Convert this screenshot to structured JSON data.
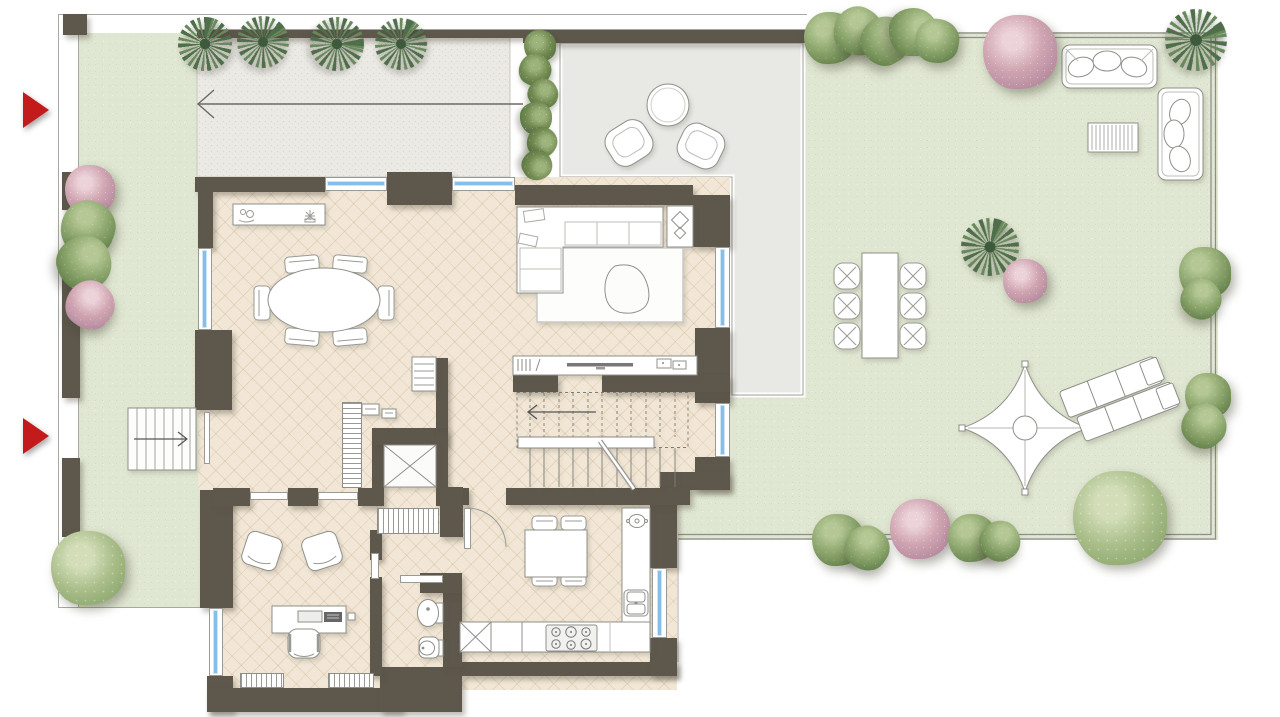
{
  "meta": {
    "kind": "architectural floor plan, top-down render",
    "scene": "ground floor apartment with wrap-around garden, gravel driveway and paved terrace",
    "visible_text": "none"
  },
  "colors": {
    "wall": "#5d574c",
    "floor": "#f2e7d6",
    "floor_line": "rgba(200,175,140,.32)",
    "green": "#dfe6d1",
    "green_dot": "#d0dbc0",
    "gravel": "#eceae5",
    "terrace": "#e8e8e5",
    "outline": "#8f8f8a",
    "thin_line": "#a8a8a3",
    "glass": "#85bfe9",
    "glass_light": "#cfe6f7",
    "red": "#c31b1c"
  },
  "entrance_markers": [
    {
      "n": "entrance-marker-top",
      "x": 23,
      "y": 92
    },
    {
      "n": "entrance-marker-bottom",
      "x": 23,
      "y": 418
    }
  ],
  "windows": [
    {
      "n": "window-dining-top-1",
      "o": "h",
      "x": 325,
      "y": 177,
      "w": 62,
      "h": 14
    },
    {
      "n": "window-dining-top-2",
      "o": "h",
      "x": 452,
      "y": 177,
      "w": 63,
      "h": 14
    },
    {
      "n": "window-dining-left",
      "o": "v",
      "x": 198,
      "y": 248,
      "w": 14,
      "h": 82
    },
    {
      "n": "window-living-right",
      "o": "v",
      "x": 715,
      "y": 247,
      "w": 15,
      "h": 81
    },
    {
      "n": "window-stairhall-right",
      "o": "v",
      "x": 715,
      "y": 403,
      "w": 15,
      "h": 54
    },
    {
      "n": "window-kitchen-right",
      "o": "v",
      "x": 652,
      "y": 568,
      "w": 15,
      "h": 70
    },
    {
      "n": "window-office-left",
      "o": "v",
      "x": 209,
      "y": 608,
      "w": 14,
      "h": 68
    }
  ],
  "walls": [
    {
      "n": "pillar-top-left",
      "x": 63,
      "y": 14,
      "w": 24,
      "h": 21
    },
    {
      "n": "boundary-seg-1",
      "x": 62,
      "y": 172,
      "w": 18,
      "h": 38
    },
    {
      "n": "boundary-seg-2",
      "x": 62,
      "y": 265,
      "w": 18,
      "h": 133
    },
    {
      "n": "boundary-seg-3",
      "x": 62,
      "y": 458,
      "w": 18,
      "h": 79
    },
    {
      "n": "gravel-top-wall",
      "x": 197,
      "y": 30,
      "w": 326,
      "h": 8
    },
    {
      "n": "terrace-top-wall",
      "x": 523,
      "y": 30,
      "w": 284,
      "h": 13
    },
    {
      "n": "top-wall-left",
      "x": 195,
      "y": 177,
      "w": 130,
      "h": 15
    },
    {
      "n": "top-wall-pier",
      "x": 387,
      "y": 172,
      "w": 65,
      "h": 33
    },
    {
      "n": "top-wall-living",
      "x": 515,
      "y": 185,
      "w": 178,
      "h": 20
    },
    {
      "n": "right-wall-a",
      "x": 693,
      "y": 195,
      "w": 37,
      "h": 52
    },
    {
      "n": "right-wall-b",
      "x": 695,
      "y": 328,
      "w": 35,
      "h": 75
    },
    {
      "n": "right-wall-c",
      "x": 695,
      "y": 457,
      "w": 35,
      "h": 33
    },
    {
      "n": "right-wall-connector",
      "x": 660,
      "y": 472,
      "w": 70,
      "h": 18
    },
    {
      "n": "left-wall-a",
      "x": 198,
      "y": 192,
      "w": 15,
      "h": 56
    },
    {
      "n": "left-wall-b",
      "x": 195,
      "y": 330,
      "w": 37,
      "h": 80
    },
    {
      "n": "left-wall-c",
      "x": 200,
      "y": 490,
      "w": 33,
      "h": 118
    },
    {
      "n": "office-corner",
      "x": 207,
      "y": 676,
      "w": 26,
      "h": 36
    },
    {
      "n": "bottom-wall-office",
      "x": 207,
      "y": 688,
      "w": 195,
      "h": 24
    },
    {
      "n": "bottom-step",
      "x": 380,
      "y": 667,
      "w": 82,
      "h": 45
    },
    {
      "n": "bottom-wall-kitchen",
      "x": 462,
      "y": 662,
      "w": 215,
      "h": 14
    },
    {
      "n": "kitchen-right-wall-a",
      "x": 650,
      "y": 490,
      "w": 27,
      "h": 78
    },
    {
      "n": "kitchen-right-wall-b",
      "x": 650,
      "y": 638,
      "w": 27,
      "h": 38
    },
    {
      "n": "living-divider-a",
      "x": 513,
      "y": 375,
      "w": 45,
      "h": 17
    },
    {
      "n": "living-divider-b",
      "x": 602,
      "y": 375,
      "w": 128,
      "h": 17
    },
    {
      "n": "hall-wall-a",
      "x": 213,
      "y": 488,
      "w": 37,
      "h": 18
    },
    {
      "n": "hall-wall-b",
      "x": 288,
      "y": 488,
      "w": 30,
      "h": 18
    },
    {
      "n": "hall-wall-c",
      "x": 358,
      "y": 488,
      "w": 15,
      "h": 18
    },
    {
      "n": "stair-wall-left-bit",
      "x": 463,
      "y": 488,
      "w": 6,
      "h": 17
    },
    {
      "n": "stair-kitchen-wall",
      "x": 506,
      "y": 488,
      "w": 184,
      "h": 17
    },
    {
      "n": "elevator-left",
      "x": 372,
      "y": 428,
      "w": 12,
      "h": 78
    },
    {
      "n": "elevator-top",
      "x": 372,
      "y": 428,
      "w": 76,
      "h": 17
    },
    {
      "n": "elevator-right",
      "x": 436,
      "y": 428,
      "w": 12,
      "h": 78
    },
    {
      "n": "stair-column",
      "x": 436,
      "y": 358,
      "w": 12,
      "h": 70
    },
    {
      "n": "closet-wall",
      "x": 440,
      "y": 487,
      "w": 23,
      "h": 50
    },
    {
      "n": "bath-wall-left-a",
      "x": 370,
      "y": 530,
      "w": 12,
      "h": 30
    },
    {
      "n": "bath-wall-left-b",
      "x": 370,
      "y": 577,
      "w": 12,
      "h": 99
    },
    {
      "n": "bath-wall-right",
      "x": 443,
      "y": 592,
      "w": 19,
      "h": 75
    },
    {
      "n": "bath-wall-top",
      "x": 420,
      "y": 573,
      "w": 42,
      "h": 20
    }
  ],
  "doors": [
    {
      "n": "door-office-1",
      "x": 250,
      "y": 492,
      "w": 38,
      "h": 8
    },
    {
      "n": "door-office-2",
      "x": 318,
      "y": 492,
      "w": 40,
      "h": 8
    },
    {
      "n": "door-bathroom",
      "x": 400,
      "y": 575,
      "w": 43,
      "h": 8
    },
    {
      "n": "door-office-bath",
      "x": 371,
      "y": 553,
      "w": 8,
      "h": 26
    },
    {
      "n": "door-entrance",
      "x": 204,
      "y": 412,
      "w": 6,
      "h": 52
    },
    {
      "n": "door-kitchen-leaf",
      "x": 464,
      "y": 508,
      "w": 7,
      "h": 41
    }
  ],
  "radiators": [
    {
      "n": "radiator-hall",
      "x": 342,
      "y": 402,
      "w": 20,
      "h": 86,
      "s": "h-stripes"
    },
    {
      "n": "closet-rack",
      "x": 377,
      "y": 508,
      "w": 62,
      "h": 26,
      "s": "v-stripes"
    },
    {
      "n": "radiator-office-1",
      "x": 240,
      "y": 673,
      "w": 44,
      "h": 15,
      "s": "v-stripes"
    },
    {
      "n": "radiator-office-2",
      "x": 328,
      "y": 673,
      "w": 46,
      "h": 15,
      "s": "v-stripes"
    }
  ],
  "plants": [
    {
      "t": "palm",
      "x": 205,
      "y": 44,
      "r": 27,
      "rot": 0
    },
    {
      "t": "palm",
      "x": 263,
      "y": 42,
      "r": 26,
      "rot": 40
    },
    {
      "t": "palm",
      "x": 337,
      "y": 44,
      "r": 27,
      "rot": 80
    },
    {
      "t": "palm",
      "x": 401,
      "y": 44,
      "r": 26,
      "rot": 15
    },
    {
      "t": "palm",
      "x": 1196,
      "y": 40,
      "r": 31,
      "rot": 55
    },
    {
      "t": "palm",
      "x": 990,
      "y": 247,
      "r": 29,
      "rot": 10
    },
    {
      "t": "hedge",
      "x": 540,
      "y": 46,
      "r": 16,
      "rot": 0
    },
    {
      "t": "hedge",
      "x": 535,
      "y": 70,
      "r": 16,
      "rot": 30
    },
    {
      "t": "hedge",
      "x": 543,
      "y": 94,
      "r": 15,
      "rot": 60
    },
    {
      "t": "hedge",
      "x": 536,
      "y": 118,
      "r": 16,
      "rot": 90
    },
    {
      "t": "hedge",
      "x": 542,
      "y": 142,
      "r": 15,
      "rot": 120
    },
    {
      "t": "hedge",
      "x": 537,
      "y": 165,
      "r": 15,
      "rot": 150
    },
    {
      "t": "pink",
      "x": 90,
      "y": 190,
      "r": 25,
      "rot": 0
    },
    {
      "t": "green",
      "x": 88,
      "y": 228,
      "r": 27,
      "rot": 20
    },
    {
      "t": "green",
      "x": 84,
      "y": 263,
      "r": 27,
      "rot": 70
    },
    {
      "t": "pink",
      "x": 90,
      "y": 305,
      "r": 24,
      "rot": 40
    },
    {
      "t": "tree",
      "x": 88,
      "y": 568,
      "r": 37,
      "rot": 0
    },
    {
      "t": "green",
      "x": 830,
      "y": 38,
      "r": 26,
      "rot": 0
    },
    {
      "t": "green",
      "x": 858,
      "y": 31,
      "r": 24,
      "rot": 30
    },
    {
      "t": "green",
      "x": 885,
      "y": 41,
      "r": 24,
      "rot": 60
    },
    {
      "t": "green",
      "x": 913,
      "y": 32,
      "r": 24,
      "rot": 90
    },
    {
      "t": "green",
      "x": 937,
      "y": 41,
      "r": 22,
      "rot": 10
    },
    {
      "t": "pink",
      "x": 1020,
      "y": 52,
      "r": 37,
      "rot": 0
    },
    {
      "t": "pink",
      "x": 1025,
      "y": 281,
      "r": 22,
      "rot": 0
    },
    {
      "t": "green",
      "x": 1205,
      "y": 273,
      "r": 26,
      "rot": 0
    },
    {
      "t": "green",
      "x": 1201,
      "y": 299,
      "r": 20,
      "rot": 45
    },
    {
      "t": "green",
      "x": 1208,
      "y": 396,
      "r": 23,
      "rot": 0
    },
    {
      "t": "green",
      "x": 1204,
      "y": 426,
      "r": 22,
      "rot": 50
    },
    {
      "t": "green",
      "x": 838,
      "y": 540,
      "r": 26,
      "rot": 0
    },
    {
      "t": "green",
      "x": 867,
      "y": 548,
      "r": 22,
      "rot": 35
    },
    {
      "t": "pink",
      "x": 920,
      "y": 529,
      "r": 30,
      "rot": 0
    },
    {
      "t": "green",
      "x": 972,
      "y": 538,
      "r": 24,
      "rot": 0
    },
    {
      "t": "green",
      "x": 1000,
      "y": 541,
      "r": 20,
      "rot": 60
    },
    {
      "t": "tree",
      "x": 1120,
      "y": 518,
      "r": 47,
      "rot": 0
    }
  ],
  "areas": [
    {
      "n": "side-yard-left"
    },
    {
      "n": "gravel-driveway"
    },
    {
      "n": "paved-terrace"
    },
    {
      "n": "garden"
    },
    {
      "n": "dining-room"
    },
    {
      "n": "living-room"
    },
    {
      "n": "stair-hall"
    },
    {
      "n": "elevator-shaft"
    },
    {
      "n": "office"
    },
    {
      "n": "bathroom"
    },
    {
      "n": "kitchen"
    }
  ],
  "furniture_inventory": {
    "dining_room": [
      "sideboard with decor",
      "oval table",
      "six chairs"
    ],
    "living_room": [
      "corner sofa",
      "rug",
      "organic coffee table",
      "tv console",
      "side table"
    ],
    "stair_hall": [
      "staircase with up arrow",
      "elevator",
      "radiator",
      "wardrobe rack"
    ],
    "office": [
      "desk with laptop",
      "desk chair",
      "two guest chairs",
      "two radiators"
    ],
    "bathroom": [
      "bidet",
      "toilet"
    ],
    "kitchen": [
      "L-shaped counter",
      "hob",
      "double sink",
      "square table with four chairs"
    ],
    "terrace": [
      "round table",
      "two lounge chairs"
    ],
    "garden": [
      "three-seat sofa",
      "two-seat sofa",
      "slatted coffee table",
      "dining table with six wicker chairs",
      "shade sail",
      "two sun loungers"
    ],
    "side_yard": [
      "entry steps with arrow"
    ],
    "driveway": [
      "direction arrow"
    ]
  }
}
